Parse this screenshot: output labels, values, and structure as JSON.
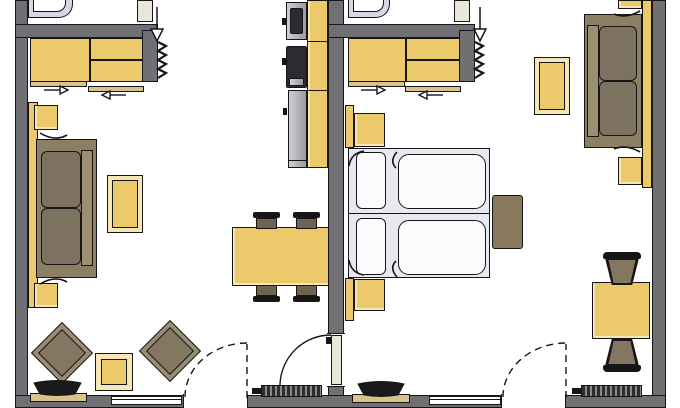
{
  "meta": {
    "title": "Floor plan — two adjacent one-room apartment units",
    "view": "top-down architectural plan",
    "visible_text": "none",
    "canvas": {
      "width_px": 680,
      "height_px": 408
    }
  },
  "colors": {
    "wall": "#6f6f74",
    "ink": "#161616",
    "floor": "#ffffff",
    "wood": "#ecc96b",
    "wood_light": "#f6e6b4",
    "track": "#d8c38c",
    "upholstery": "#7d7160",
    "sofa_frame": "#8d7f63",
    "sofa_front": "#9c8e71",
    "chair_seat": "#6f6352",
    "lounge_frame": "#998c74",
    "lounge_seat": "#847762",
    "bed_base": "#e8e8f1",
    "linen": "#fbfbfd",
    "shower": "#d6d6e4",
    "appliance_dark": "#2b2b30",
    "appliance_metal": "#b6b6bd",
    "door_leaf": "#eae6d8",
    "bench": "#897a5d"
  },
  "left_unit": {
    "label": "left unit (living room with kitchenette)",
    "rooms": [
      "bathroom with shower (partially visible at top)",
      "entry with wardrobe",
      "living room"
    ],
    "furniture": [
      "shower tray",
      "entry door with inward arrow",
      "coat hooks",
      "sliding-door wardrobe (2 doors, opposing slide arrows)",
      "kitchenette: sink unit, cooktop, refrigerator, worktop run",
      "wall console shelf",
      "2 side tables",
      "two-seat sofa",
      "coffee table",
      "2 angled lounge chairs",
      "occasional table",
      "TV on lowboard",
      "dining table with 4 chairs",
      "radiator",
      "window",
      "balcony door (dashed swing)",
      "connecting door to right unit (solid swing)"
    ]
  },
  "right_unit": {
    "label": "right unit (bedroom / living)",
    "rooms": [
      "bathroom with shower (partially visible at top)",
      "entry with wardrobe",
      "bed-sitting room"
    ],
    "furniture": [
      "shower tray",
      "entry door with inward arrow",
      "coat hooks",
      "sliding-door wardrobe (2 doors, opposing slide arrows)",
      "double bed: 2 mattresses, 2 pillows, 2 duvets",
      "2 nightstands with wall console",
      "foot bench",
      "two-seat sofa",
      "wall console shelf",
      "2 side tables",
      "coffee table",
      "square table with 2 barrel chairs",
      "TV on lowboard",
      "radiator",
      "window",
      "balcony door (dashed swing)"
    ]
  },
  "symbols": {
    "entry_arrows": 2,
    "sliding_door_arrows": [
      "right",
      "left",
      "right",
      "left"
    ],
    "door_swings": {
      "solid_interior": 1,
      "dashed_balcony": 2
    },
    "radiators": 2
  }
}
